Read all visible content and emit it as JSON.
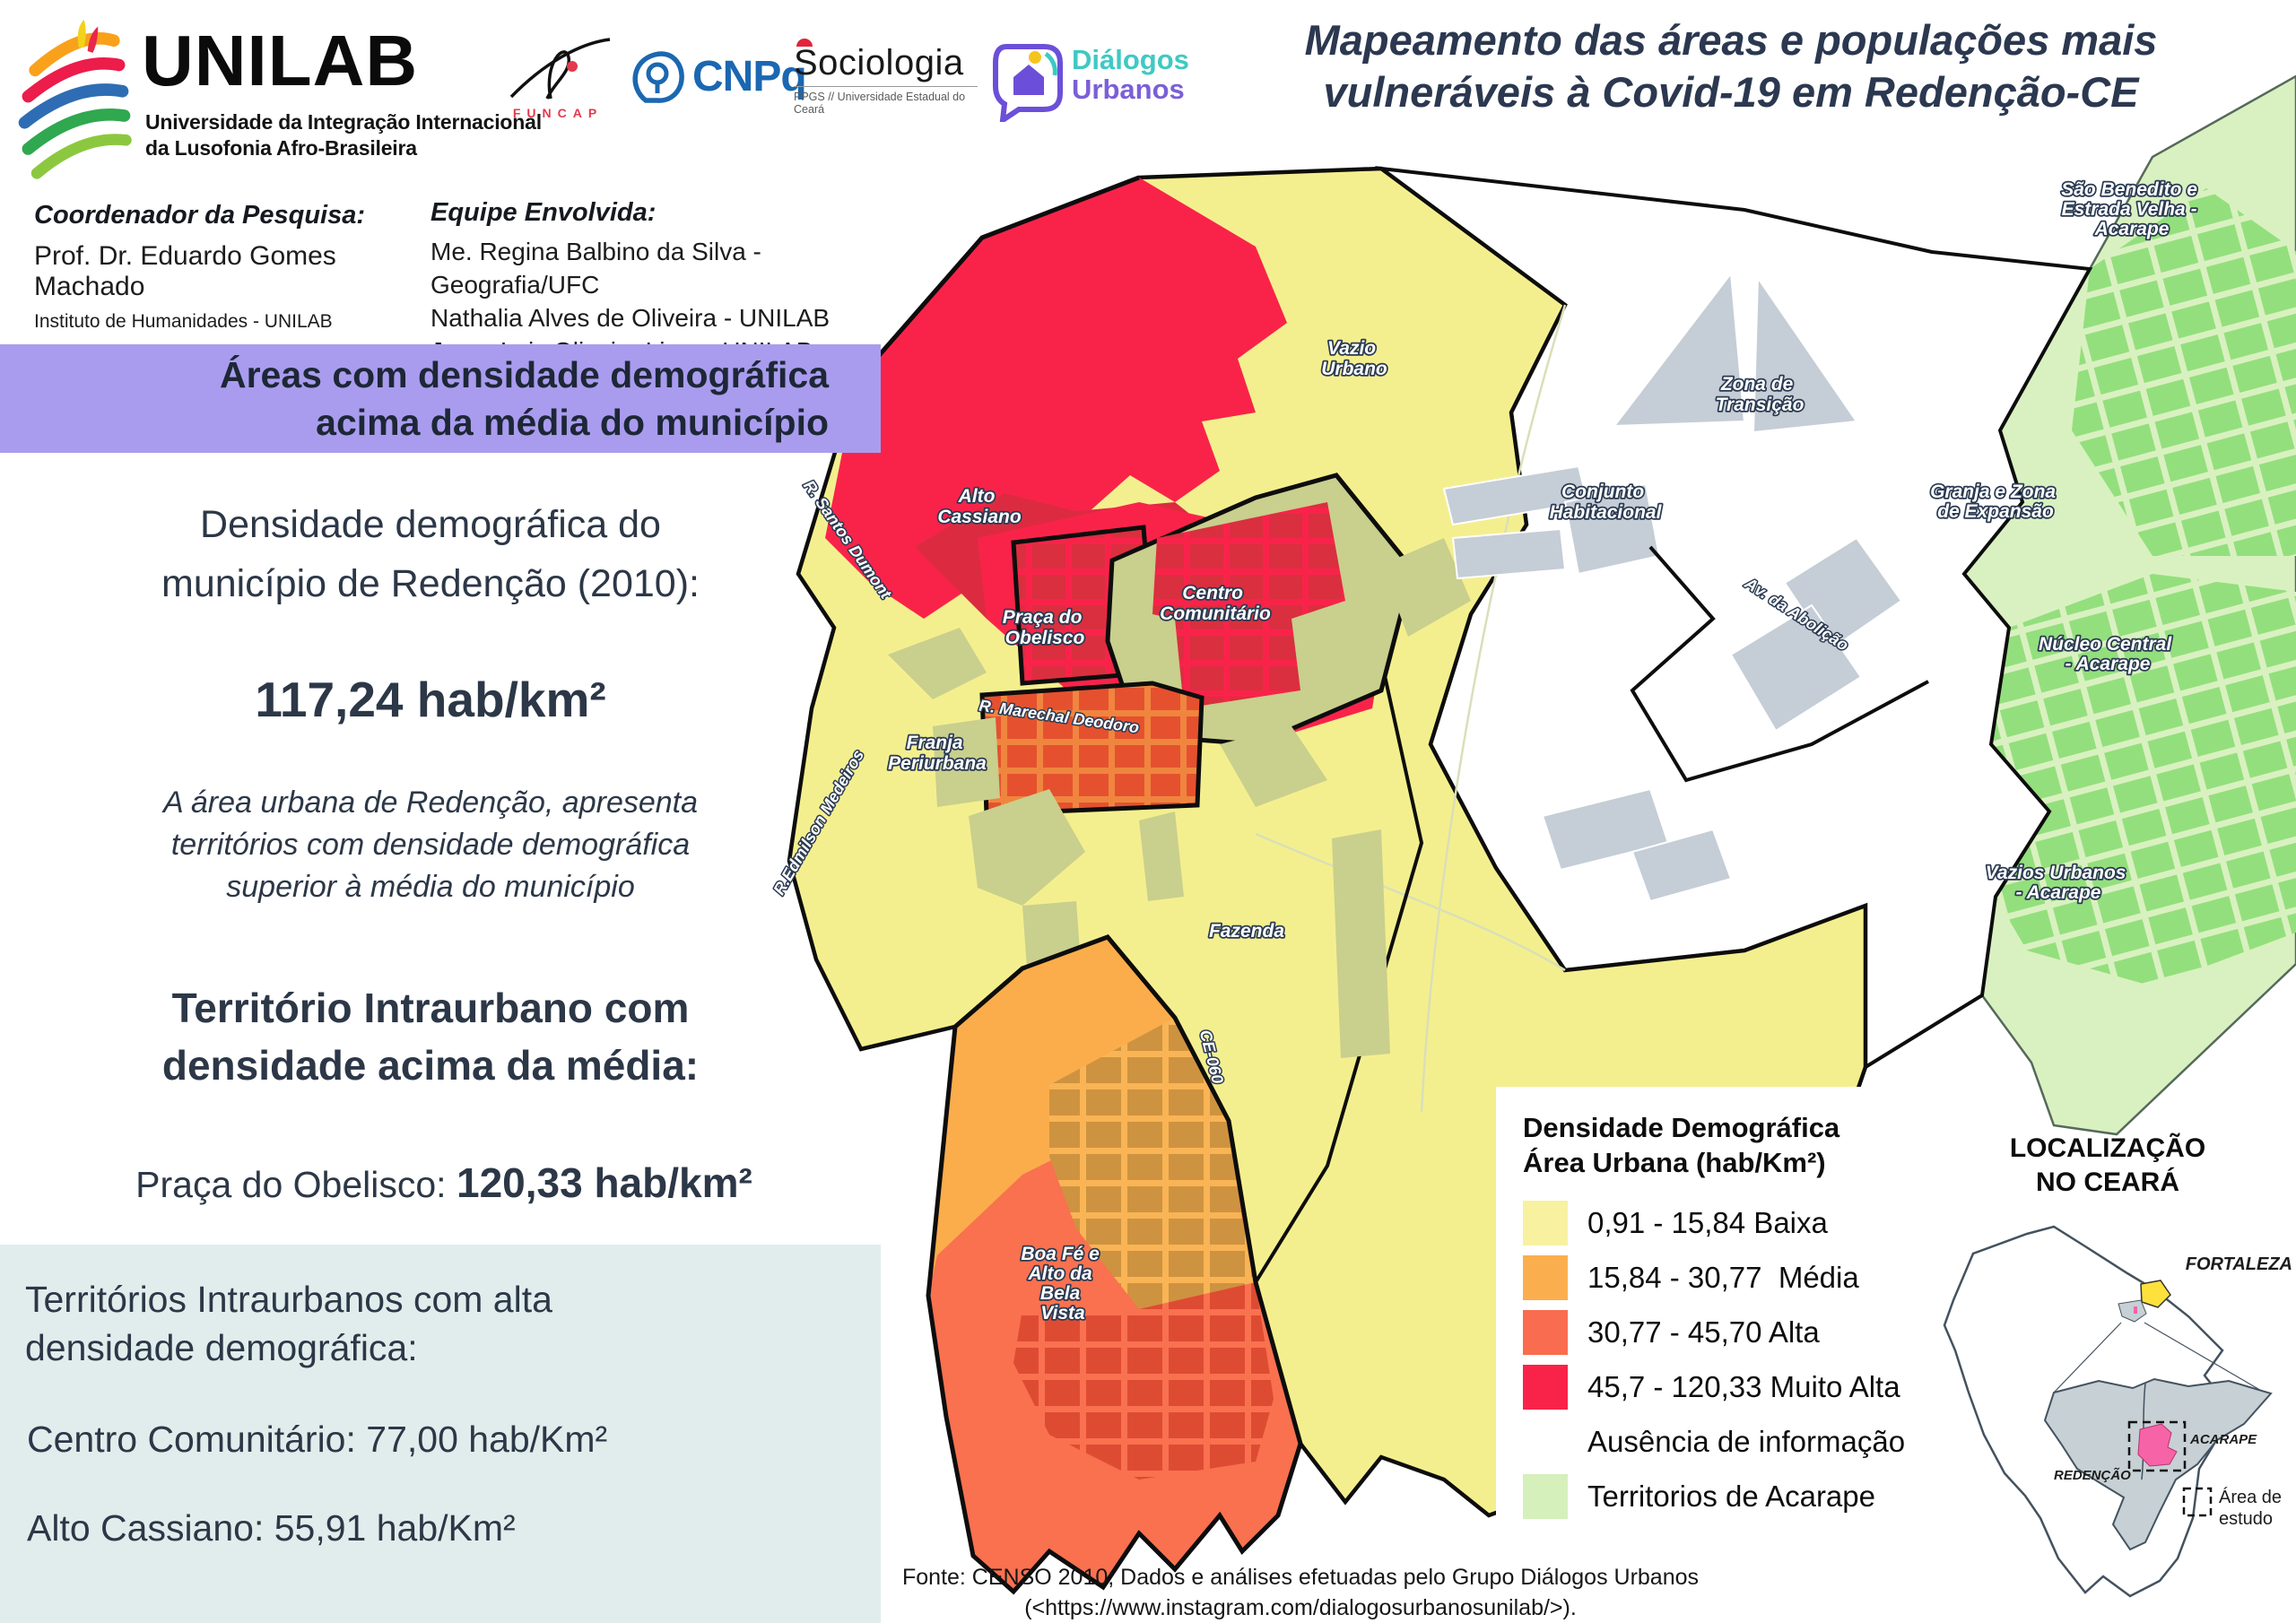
{
  "header": {
    "unilab_name": "UNILAB",
    "unilab_sub1": "Universidade da Integração Internacional",
    "unilab_sub2": "da Lusofonia Afro-Brasileira",
    "funcap_label": "FUNCAP",
    "cnpq_label": "CNPq",
    "sociologia_label": "Sociologia",
    "sociologia_sub": "PPGS // Universidade Estadual do Ceará",
    "dialogos_line1": "Diálogos",
    "dialogos_line2": "Urbanos",
    "title_line1": "Mapeamento das áreas e populações mais",
    "title_line2": "vulneráveis à Covid-19 em Redenção-CE"
  },
  "credits": {
    "coord_label": "Coordenador da Pesquisa:",
    "coord_name": "Prof. Dr. Eduardo Gomes Machado",
    "coord_inst": "Instituto de Humanidades - UNILAB",
    "team_label": "Equipe Envolvida:",
    "team": [
      "Me. Regina Balbino da Silva - Geografia/UFC",
      "Nathalia Alves de Oliveira - UNILAB",
      "Jorge Luiz Oliveira Lima - UNILAB",
      "Vladimir Bucal - UNILAB"
    ]
  },
  "left_panel": {
    "banner_line1": "Áreas com densidade demográfica",
    "banner_line2": "acima da média do município",
    "density_line1": "Densidade demográfica do",
    "density_line2": "município de Redenção (2010):",
    "density_value": "117,24 hab/km²",
    "para_line1": "A área urbana de Redenção, apresenta",
    "para_line2": "territórios com densidade demográfica",
    "para_line3": "superior à média do município",
    "terr_line1": "Território Intraurbano com",
    "terr_line2": "densidade acima da média:",
    "obelisco_label": "Praça do Obelisco:",
    "obelisco_value": "120,33 hab/km²",
    "box_head_line1": "Territórios Intraurbanos com alta",
    "box_head_line2": "densidade demográfica:",
    "box_item1": "Centro Comunitário: 77,00 hab/Km²",
    "box_item2": "Alto Cassiano: 55,91 hab/Km²"
  },
  "map": {
    "labels": {
      "vazio_urbano": {
        "l1": "Vazio",
        "l2": "Urbano"
      },
      "zona_transicao": {
        "l1": "Zona de",
        "l2": "Transição"
      },
      "conjunto_habitacional": {
        "l1": "Conjunto",
        "l2": "Habitacional"
      },
      "alto_cassiano": {
        "l1": "Alto",
        "l2": "Cassiano"
      },
      "centro_comunitario": {
        "l1": "Centro",
        "l2": "Comunitário"
      },
      "praca_obelisco": {
        "l1": "Praça do",
        "l2": "Obelisco"
      },
      "franja_periurbana": {
        "l1": "Franja",
        "l2": "Periurbana"
      },
      "fazenda": {
        "l1": "Fazenda"
      },
      "boa_fe": {
        "l1": "Boa Fé e",
        "l2": "Alto da",
        "l3": "Bela",
        "l4": "Vista"
      },
      "sao_benedito": {
        "l1": "São Benedito e",
        "l2": "Estrada Velha -",
        "l3": "Acarape"
      },
      "granja": {
        "l1": "Granja e Zona",
        "l2": "de Expansão"
      },
      "nucleo_central": {
        "l1": "Núcleo Central",
        "l2": "- Acarape"
      },
      "vazios_urbanos": {
        "l1": "Vazios Urbanos",
        "l2": "- Acarape"
      }
    },
    "streets": {
      "santos_dumont": "R. Santos Dumont",
      "edmilson_medeiros": "R.Edmilson Medeiros",
      "marechal_deodoro": "R. Marechal Deodoro",
      "av_abolicao": "Av. da Abolição",
      "ce060": "CE-060"
    }
  },
  "legend": {
    "title_line1": "Densidade Demográfica",
    "title_line2": "Área Urbana (hab/Km²)",
    "items": [
      {
        "label": "0,91 - 15,84 Baixa",
        "color": "#F8F1A0"
      },
      {
        "label": "15,84 - 30,77  Média",
        "color": "#FBAE4D"
      },
      {
        "label": "30,77 - 45,70 Alta",
        "color": "#F96C4F"
      },
      {
        "label": "45,7 - 120,33 Muito Alta",
        "color": "#F9234A"
      },
      {
        "label": "Ausência de informação",
        "color": "#FFFFFF"
      },
      {
        "label": "Territorios de Acarape",
        "color": "#D5F0BA"
      }
    ]
  },
  "inset": {
    "title_line1": "LOCALIZAÇÃO",
    "title_line2": "NO CEARÁ",
    "fortaleza": "FORTALEZA",
    "redencao": "REDENÇÃO",
    "acarape": "ACARAPE",
    "area_line1": "Área de",
    "area_line2": "estudo"
  },
  "footer": {
    "line1": "Fonte: CENSO 2010; Dados e análises efetuadas pelo Grupo Diálogos Urbanos",
    "line2": "(<https://www.instagram.com/dialogosurbanosunilab/>)."
  },
  "colors": {
    "banner_bg": "#A99CEF",
    "box_bg": "#E1EDEC",
    "title_text": "#2B3850",
    "map_yellow": "#F4EF8E",
    "map_olive": "#C9CF8D",
    "map_orange": "#FBAD4B",
    "map_orange_block": "#CE9340",
    "map_alta": "#F9714F",
    "map_alta_block": "#DE4B33",
    "map_red": "#F9234A",
    "map_red_dark": "#DC2B40",
    "map_gray": "#C5CDD6",
    "map_green_base": "#D9F1C0",
    "map_green_block": "#93DF7D",
    "inset_pink": "#F763A7",
    "inset_gray": "#C6D0D5",
    "fortaleza_yellow": "#FFE13C"
  }
}
